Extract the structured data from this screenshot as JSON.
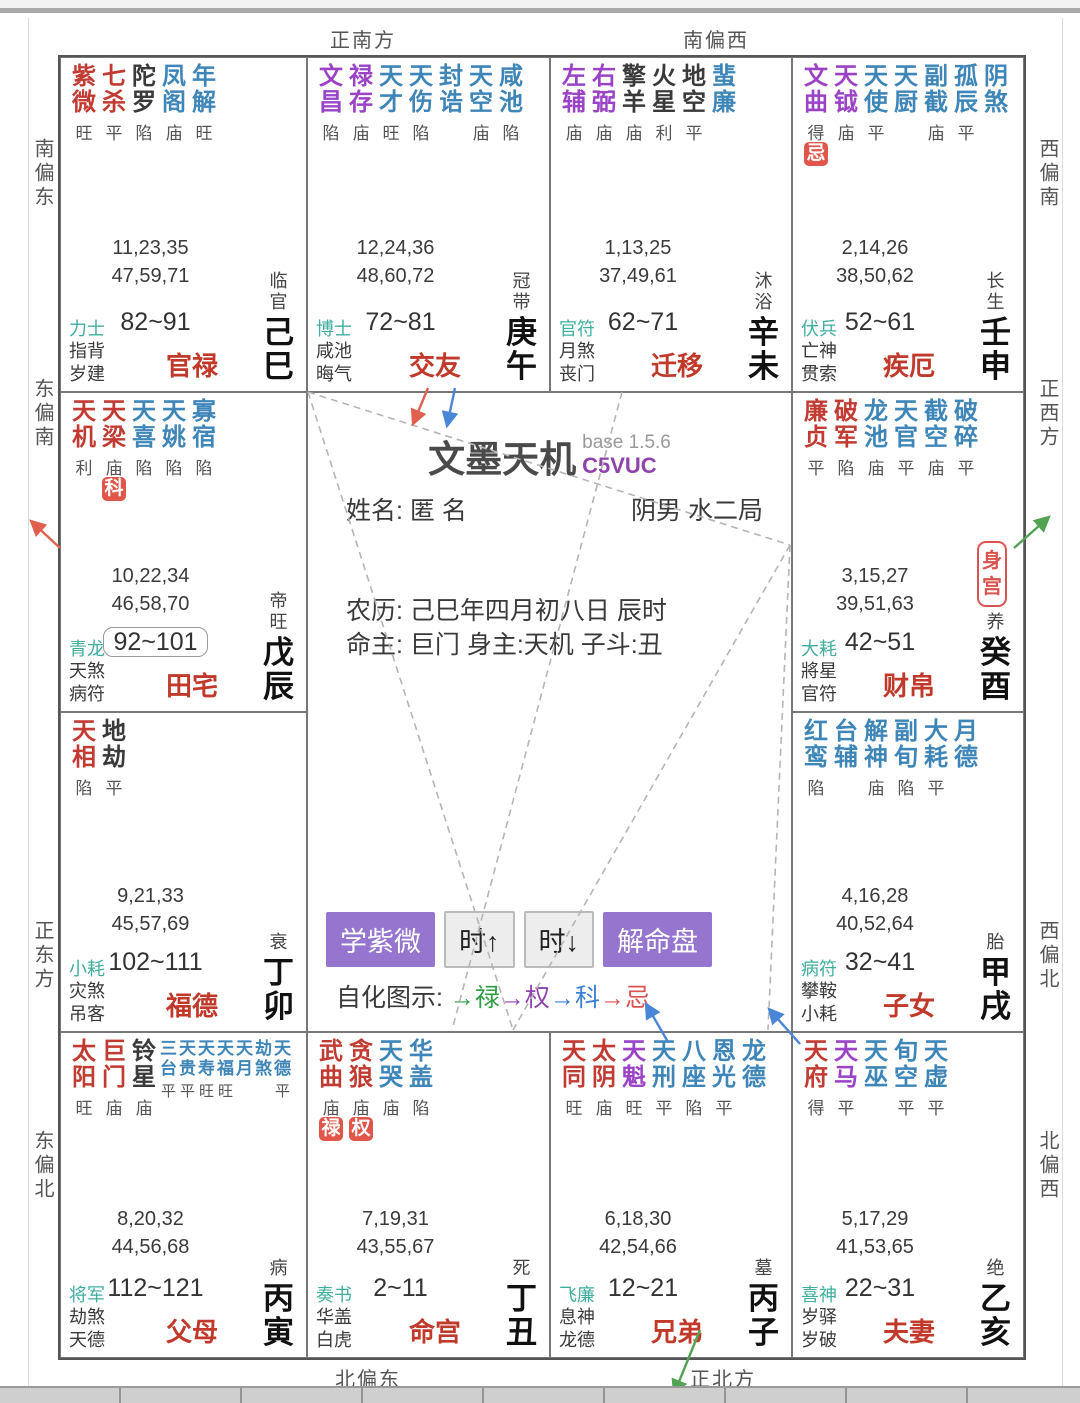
{
  "colors": {
    "red": "#c23b33",
    "purple": "#9b43c7",
    "blue": "#3f86b8",
    "black": "#3a3a3a",
    "teal": "#3fae9f",
    "badge_bg": "#e0564a",
    "accent_purple": "#9575cd"
  },
  "directions": {
    "top_left": "正南方",
    "top_right": "南偏西",
    "bottom_left": "北偏东",
    "bottom_right": "正北方",
    "left": [
      "南偏东",
      "东偏南",
      "正东方",
      "东偏北"
    ],
    "right": [
      "西偏南",
      "正西方",
      "西偏北",
      "北偏西"
    ]
  },
  "center": {
    "title": "文墨天机",
    "version": "base 1.5.6",
    "code": "C5VUC",
    "name_label": "姓名:",
    "name_value": "匿 名",
    "gender_bureau": "阴男 水二局",
    "lunar": "农历: 己巳年四月初八日 辰时",
    "masters": "命主: 巨门 身主:天机 子斗:丑",
    "buttons": {
      "learn": "学紫微",
      "hour_up": "时↑",
      "hour_down": "时↓",
      "interpret": "解命盘"
    },
    "legend_label": "自化图示:",
    "legend": [
      {
        "arrow": "→",
        "text": "禄",
        "color": "green"
      },
      {
        "arrow": "→",
        "text": "权",
        "color": "purple"
      },
      {
        "arrow": "→",
        "text": "科",
        "color": "blue"
      },
      {
        "arrow": "→",
        "text": "忌",
        "color": "red"
      }
    ]
  },
  "palaces": [
    {
      "slot": "r1c1",
      "stars": [
        {
          "n": "紫微",
          "c": "red",
          "b": "旺"
        },
        {
          "n": "七杀",
          "c": "red",
          "b": "平"
        },
        {
          "n": "陀罗",
          "c": "black",
          "b": "陷"
        },
        {
          "n": "凤阁",
          "c": "blue",
          "b": "庙"
        },
        {
          "n": "年解",
          "c": "blue",
          "b": "旺"
        }
      ],
      "numbers": [
        "11,23,35",
        "47,59,71"
      ],
      "deity": "力士",
      "row2": "指背",
      "row3": "岁建",
      "age": "82~91",
      "boxed": false,
      "palace": "官禄",
      "stage": "临官",
      "branch": "己巳",
      "body_palace": false
    },
    {
      "slot": "r1c2",
      "stars": [
        {
          "n": "文昌",
          "c": "purple",
          "b": "陷"
        },
        {
          "n": "禄存",
          "c": "purple",
          "b": "庙"
        },
        {
          "n": "天才",
          "c": "blue",
          "b": "旺"
        },
        {
          "n": "天伤",
          "c": "blue",
          "b": "陷"
        },
        {
          "n": "封诰",
          "c": "blue",
          "b": ""
        },
        {
          "n": "天空",
          "c": "blue",
          "b": "庙"
        },
        {
          "n": "咸池",
          "c": "blue",
          "b": "陷"
        }
      ],
      "numbers": [
        "12,24,36",
        "48,60,72"
      ],
      "deity": "博士",
      "row2": "咸池",
      "row3": "晦气",
      "age": "72~81",
      "boxed": false,
      "palace": "交友",
      "stage": "冠带",
      "branch": "庚午",
      "body_palace": false
    },
    {
      "slot": "r1c3",
      "stars": [
        {
          "n": "左辅",
          "c": "purple",
          "b": "庙"
        },
        {
          "n": "右弼",
          "c": "purple",
          "b": "庙"
        },
        {
          "n": "擎羊",
          "c": "black",
          "b": "庙"
        },
        {
          "n": "火星",
          "c": "black",
          "b": "利"
        },
        {
          "n": "地空",
          "c": "black",
          "b": "平"
        },
        {
          "n": "蜚廉",
          "c": "blue",
          "b": ""
        }
      ],
      "numbers": [
        "1,13,25",
        "37,49,61"
      ],
      "deity": "官符",
      "row2": "月煞",
      "row3": "丧门",
      "age": "62~71",
      "boxed": false,
      "palace": "迁移",
      "stage": "沐浴",
      "branch": "辛未",
      "body_palace": false
    },
    {
      "slot": "r1c4",
      "stars": [
        {
          "n": "文曲",
          "c": "purple",
          "b": "得",
          "badge": "忌"
        },
        {
          "n": "天钺",
          "c": "purple",
          "b": "庙"
        },
        {
          "n": "天使",
          "c": "blue",
          "b": "平"
        },
        {
          "n": "天厨",
          "c": "blue",
          "b": ""
        },
        {
          "n": "副截",
          "c": "blue",
          "b": "庙"
        },
        {
          "n": "孤辰",
          "c": "blue",
          "b": "平"
        },
        {
          "n": "阴煞",
          "c": "blue",
          "b": ""
        }
      ],
      "numbers": [
        "2,14,26",
        "38,50,62"
      ],
      "deity": "伏兵",
      "row2": "亡神",
      "row3": "贯索",
      "age": "52~61",
      "boxed": false,
      "palace": "疾厄",
      "stage": "长生",
      "branch": "壬申",
      "body_palace": false
    },
    {
      "slot": "r2c1",
      "stars": [
        {
          "n": "天机",
          "c": "red",
          "b": "利"
        },
        {
          "n": "天梁",
          "c": "red",
          "b": "庙",
          "badge": "科"
        },
        {
          "n": "天喜",
          "c": "blue",
          "b": "陷"
        },
        {
          "n": "天姚",
          "c": "blue",
          "b": "陷"
        },
        {
          "n": "寡宿",
          "c": "blue",
          "b": "陷"
        }
      ],
      "numbers": [
        "10,22,34",
        "46,58,70"
      ],
      "deity": "青龙",
      "row2": "天煞",
      "row3": "病符",
      "age": "92~101",
      "boxed": true,
      "palace": "田宅",
      "stage": "帝旺",
      "branch": "戊辰",
      "body_palace": false
    },
    {
      "slot": "r2c4",
      "stars": [
        {
          "n": "廉贞",
          "c": "red",
          "b": "平"
        },
        {
          "n": "破军",
          "c": "red",
          "b": "陷"
        },
        {
          "n": "龙池",
          "c": "blue",
          "b": "庙"
        },
        {
          "n": "天官",
          "c": "blue",
          "b": "平"
        },
        {
          "n": "截空",
          "c": "blue",
          "b": "庙"
        },
        {
          "n": "破碎",
          "c": "blue",
          "b": "平"
        }
      ],
      "numbers": [
        "3,15,27",
        "39,51,63"
      ],
      "deity": "大耗",
      "row2": "將星",
      "row3": "官符",
      "age": "42~51",
      "boxed": false,
      "palace": "财帛",
      "stage": "养",
      "branch": "癸酉",
      "body_palace": true,
      "body_label": "身宫"
    },
    {
      "slot": "r3c1",
      "stars": [
        {
          "n": "天相",
          "c": "red",
          "b": "陷"
        },
        {
          "n": "地劫",
          "c": "black",
          "b": "平"
        }
      ],
      "numbers": [
        "9,21,33",
        "45,57,69"
      ],
      "deity": "小耗",
      "row2": "灾煞",
      "row3": "吊客",
      "age": "102~111",
      "boxed": false,
      "palace": "福德",
      "stage": "衰",
      "branch": "丁卯",
      "body_palace": false
    },
    {
      "slot": "r3c4",
      "stars": [
        {
          "n": "红鸾",
          "c": "blue",
          "b": "陷"
        },
        {
          "n": "台辅",
          "c": "blue",
          "b": ""
        },
        {
          "n": "解神",
          "c": "blue",
          "b": "庙"
        },
        {
          "n": "副旬",
          "c": "blue",
          "b": "陷"
        },
        {
          "n": "大耗",
          "c": "blue",
          "b": "平"
        },
        {
          "n": "月德",
          "c": "blue",
          "b": ""
        }
      ],
      "numbers": [
        "4,16,28",
        "40,52,64"
      ],
      "deity": "病符",
      "row2": "攀鞍",
      "row3": "小耗",
      "age": "32~41",
      "boxed": false,
      "palace": "子女",
      "stage": "胎",
      "branch": "甲戌",
      "body_palace": false
    },
    {
      "slot": "r4c1",
      "stars": [
        {
          "n": "太阳",
          "c": "red",
          "b": "旺"
        },
        {
          "n": "巨门",
          "c": "red",
          "b": "庙"
        },
        {
          "n": "铃星",
          "c": "black",
          "b": "庙"
        }
      ],
      "small_stars": [
        {
          "n": "三台",
          "c": "blue",
          "b": "平"
        },
        {
          "n": "天贵",
          "c": "blue",
          "b": "平"
        },
        {
          "n": "天寿",
          "c": "blue",
          "b": "旺"
        },
        {
          "n": "天福",
          "c": "blue",
          "b": "旺"
        },
        {
          "n": "天月",
          "c": "blue",
          "b": ""
        },
        {
          "n": "劫煞",
          "c": "blue",
          "b": ""
        },
        {
          "n": "天德",
          "c": "blue",
          "b": "平"
        }
      ],
      "numbers": [
        "8,20,32",
        "44,56,68"
      ],
      "deity": "将军",
      "row2": "劫煞",
      "row3": "天德",
      "age": "112~121",
      "boxed": false,
      "palace": "父母",
      "stage": "病",
      "branch": "丙寅",
      "body_palace": false
    },
    {
      "slot": "r4c2",
      "stars": [
        {
          "n": "武曲",
          "c": "red",
          "b": "庙",
          "badge": "禄"
        },
        {
          "n": "贪狼",
          "c": "red",
          "b": "庙",
          "badge": "权"
        },
        {
          "n": "天哭",
          "c": "blue",
          "b": "庙"
        },
        {
          "n": "华盖",
          "c": "blue",
          "b": "陷"
        }
      ],
      "numbers": [
        "7,19,31",
        "43,55,67"
      ],
      "deity": "奏书",
      "row2": "华盖",
      "row3": "白虎",
      "age": "2~11",
      "boxed": false,
      "palace": "命宫",
      "stage": "死",
      "branch": "丁丑",
      "body_palace": false
    },
    {
      "slot": "r4c3",
      "stars": [
        {
          "n": "天同",
          "c": "red",
          "b": "旺"
        },
        {
          "n": "太阴",
          "c": "red",
          "b": "庙"
        },
        {
          "n": "天魁",
          "c": "purple",
          "b": "旺"
        },
        {
          "n": "天刑",
          "c": "blue",
          "b": "平"
        },
        {
          "n": "八座",
          "c": "blue",
          "b": "陷"
        },
        {
          "n": "恩光",
          "c": "blue",
          "b": "平"
        },
        {
          "n": "龙德",
          "c": "blue",
          "b": ""
        }
      ],
      "numbers": [
        "6,18,30",
        "42,54,66"
      ],
      "deity": "飞廉",
      "row2": "息神",
      "row3": "龙德",
      "age": "12~21",
      "boxed": false,
      "palace": "兄弟",
      "stage": "墓",
      "branch": "丙子",
      "body_palace": false
    },
    {
      "slot": "r4c4",
      "stars": [
        {
          "n": "天府",
          "c": "red",
          "b": "得"
        },
        {
          "n": "天马",
          "c": "purple",
          "b": "平"
        },
        {
          "n": "天巫",
          "c": "blue",
          "b": ""
        },
        {
          "n": "旬空",
          "c": "blue",
          "b": "平"
        },
        {
          "n": "天虚",
          "c": "blue",
          "b": "平"
        }
      ],
      "numbers": [
        "5,17,29",
        "41,53,65"
      ],
      "deity": "喜神",
      "row2": "岁驿",
      "row3": "岁破",
      "age": "22~31",
      "boxed": false,
      "palace": "夫妻",
      "stage": "绝",
      "branch": "乙亥",
      "body_palace": false
    }
  ]
}
